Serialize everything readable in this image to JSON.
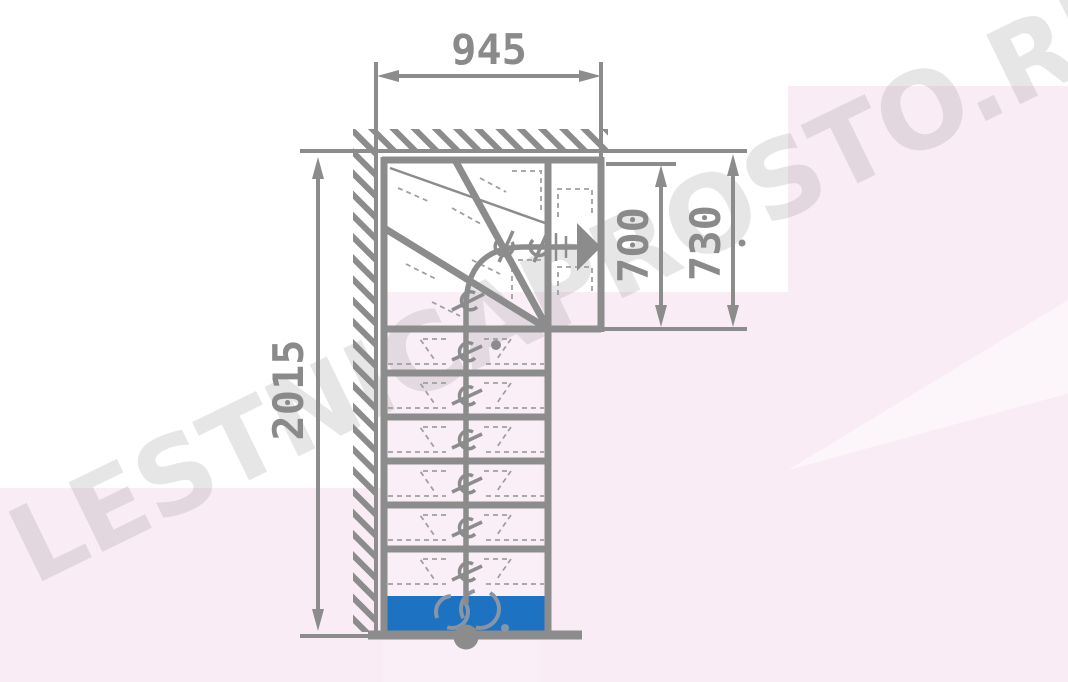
{
  "watermark": {
    "text": "LESTNICAPROSTO.RU"
  },
  "dimensions": {
    "top_width": "945",
    "left_total_height": "2015",
    "right_inner_height": "700",
    "right_outer_height": "730"
  },
  "colors": {
    "line_gray": "#8c8c8c",
    "dashed_gray": "#a0a0a0",
    "text_gray": "#8a8a8a",
    "first_step_blue": "#1e72c2",
    "background_pink": "#f9ecf4",
    "watermark_gray": "#969096",
    "canvas_white": "#ffffff"
  }
}
